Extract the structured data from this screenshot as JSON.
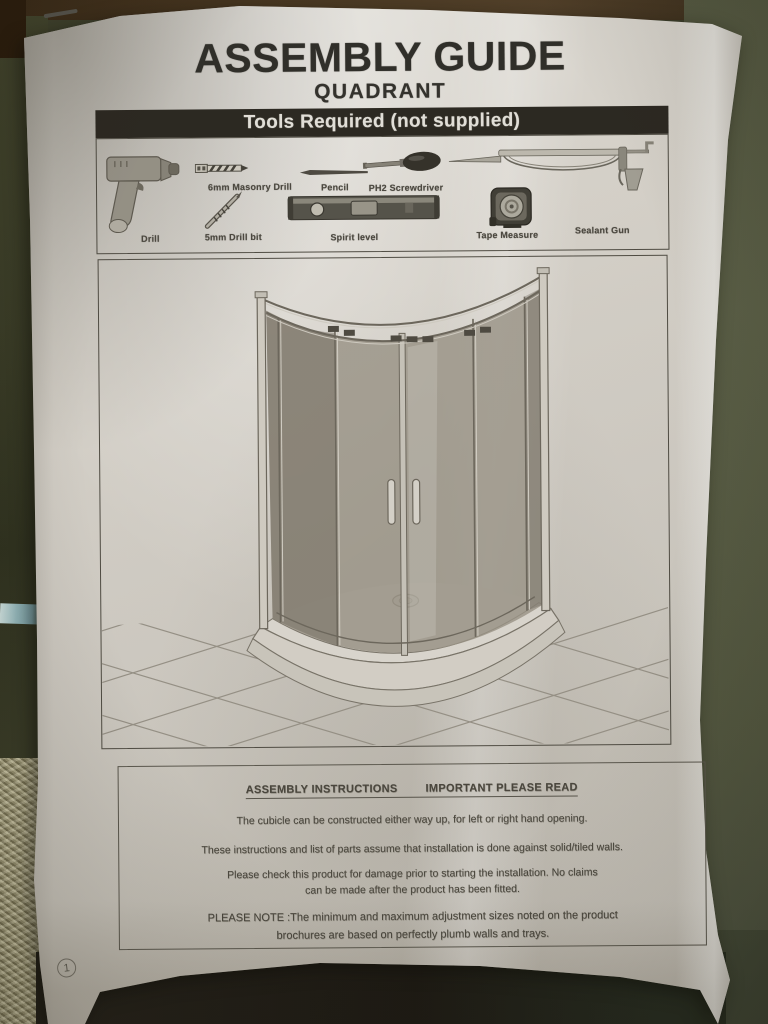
{
  "photo": {
    "description": "Photograph of a printed shower enclosure assembly guide sheet lying on a dark surface"
  },
  "document": {
    "title": "ASSEMBLY GUIDE",
    "subtitle": "QUADRANT",
    "tools_section": {
      "header": "Tools Required (not supplied)",
      "tools": [
        {
          "label": "Drill",
          "icon": "power-drill-icon"
        },
        {
          "label": "6mm Masonry Drill",
          "icon": "masonry-drill-bit-icon"
        },
        {
          "label": "Pencil",
          "icon": "pencil-icon"
        },
        {
          "label": "PH2 Screwdriver",
          "icon": "ph2-screwdriver-icon"
        },
        {
          "label": "5mm Drill bit",
          "icon": "drill-bit-icon"
        },
        {
          "label": "Spirit level",
          "icon": "spirit-level-icon"
        },
        {
          "label": "Tape Measure",
          "icon": "tape-measure-icon"
        },
        {
          "label": "Sealant Gun",
          "icon": "sealant-gun-icon"
        }
      ]
    },
    "diagram": {
      "depicts": "Quadrant shower enclosure with curved sliding doors on a quadrant tray with centre drain, standing on a tiled floor"
    },
    "instructions": {
      "heading_left": "ASSEMBLY INSTRUCTIONS",
      "heading_right": "IMPORTANT PLEASE READ",
      "paragraphs": [
        "The cubicle can be constructed either way up, for left or right hand opening.",
        "These instructions and list of parts assume that installation is done against solid/tiled walls.",
        "Please check this product for damage prior to starting the installation. No claims can be made after the product has been fitted.",
        "PLEASE NOTE :The minimum and maximum adjustment sizes noted on the product brochures are based on perfectly plumb walls and trays."
      ]
    },
    "page_number": "1"
  },
  "colors": {
    "header_bar_bg": "#2b2822",
    "paper": "#dcd8d1",
    "background_olive": "#5c6149",
    "background_brown": "#4c3a24"
  }
}
